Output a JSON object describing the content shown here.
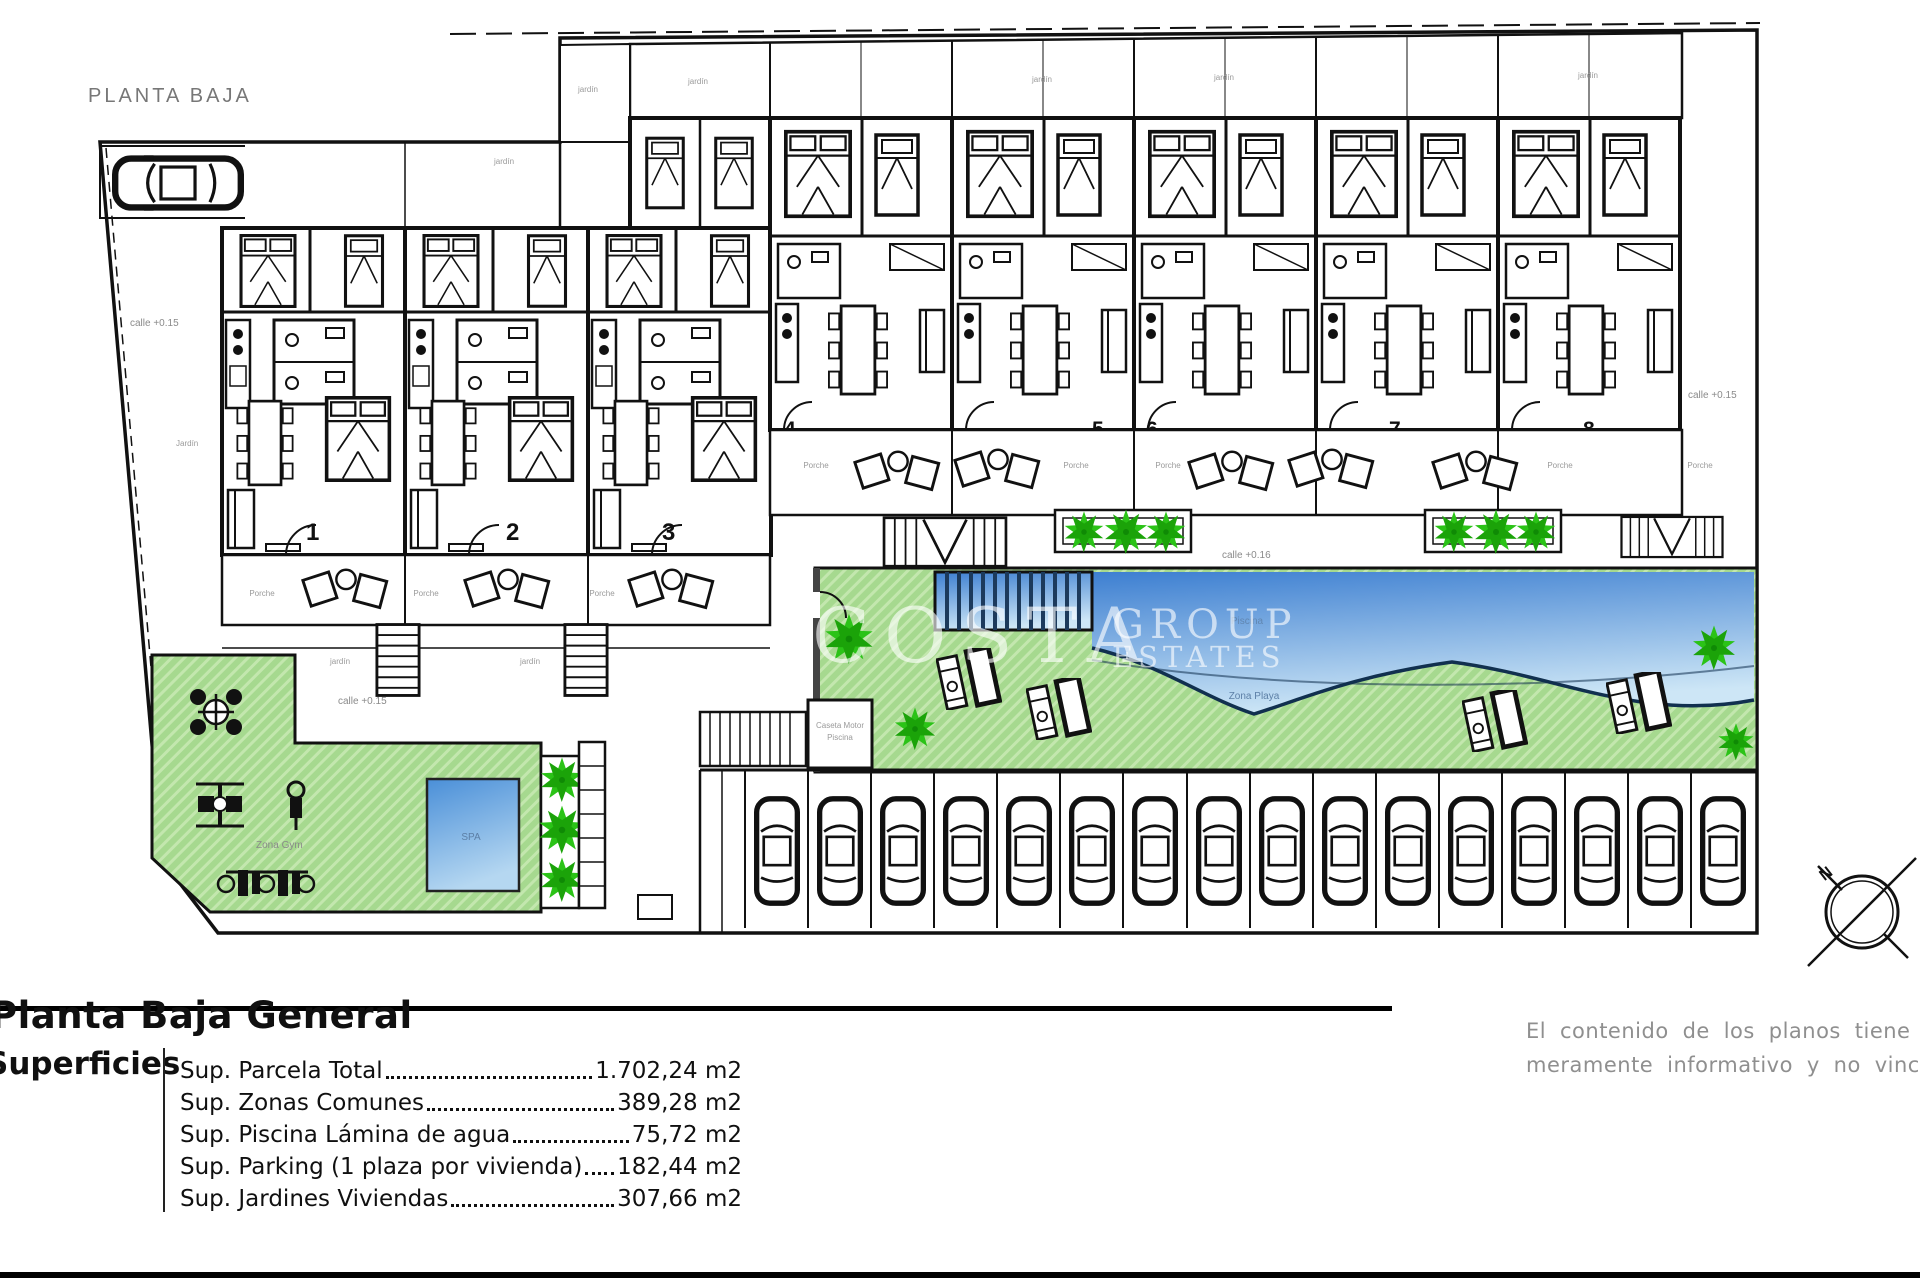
{
  "title": "PLANTA BAJA",
  "watermark": {
    "name": "COSTA",
    "word1": "GROUP",
    "word2": "ESTATES"
  },
  "units": [
    "1",
    "2",
    "3",
    "4",
    "5",
    "6",
    "7",
    "8"
  ],
  "labels": {
    "porch": "Porche",
    "garden": "jardín",
    "garden_cap": "Jardín",
    "spa": "SPA",
    "gym": "Zona Gym",
    "pool": "Piscina",
    "beach": "Zona Playa",
    "pump1": "Caseta Motor",
    "pump2": "Piscina",
    "north": "N"
  },
  "streets": [
    "calle +0.15",
    "calle +0.15",
    "calle +0.16",
    "calle +0.15"
  ],
  "legend": {
    "title": "Planta Baja General",
    "section": "Superficies",
    "items": [
      {
        "label": "Sup. Parcela Total",
        "value": "1.702,24 m2"
      },
      {
        "label": "Sup. Zonas Comunes",
        "value": "389,28 m2"
      },
      {
        "label": "Sup. Piscina Lámina de agua",
        "value": "75,72 m2"
      },
      {
        "label": "Sup. Parking (1 plaza por vivienda)",
        "value": "182,44 m2"
      },
      {
        "label": "Sup. Jardines Viviendas",
        "value": "307,66 m2"
      }
    ]
  },
  "disclaimer": {
    "line1": "El contenido de los planos tiene valo",
    "line2": "meramente informativo y no vinculan"
  },
  "colors": {
    "garden_green": "#a6d98f",
    "palm_green": "#2bc317",
    "pool_top": "#3d7fd1",
    "pool_bottom": "#cde6f6",
    "wall_black": "#111111",
    "label_gray": "#8a8a8a"
  }
}
